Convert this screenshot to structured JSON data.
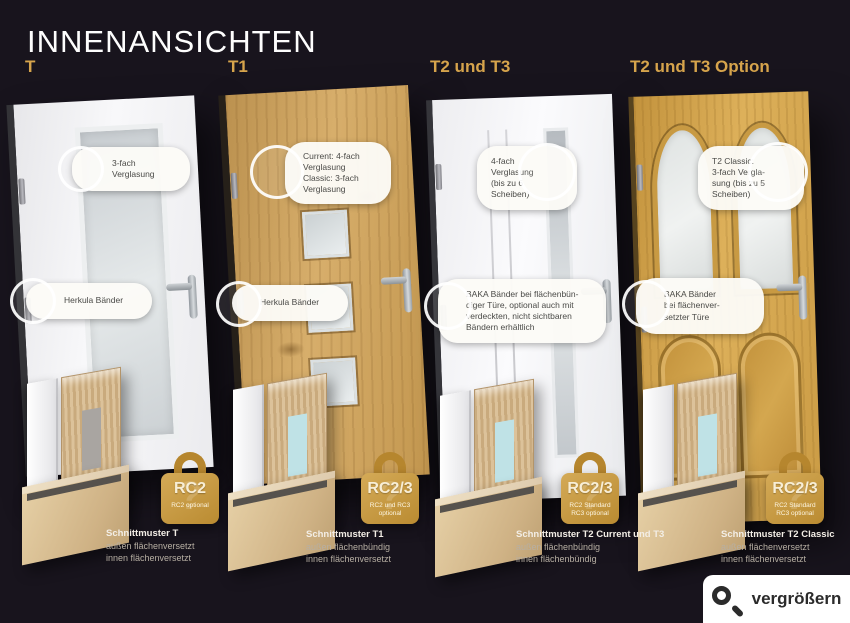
{
  "page": {
    "title": "INNENANSICHTEN"
  },
  "colors": {
    "background": "#18141d",
    "accent_gold": "#d6a44c",
    "lock_gold": "#c79a43",
    "callout_bg": "#fcfbf7"
  },
  "columns": [
    {
      "header": "T",
      "callouts": [
        {
          "text": "3-fach\nVerglasung"
        },
        {
          "text": "Herkula Bänder"
        }
      ],
      "lock": {
        "rating": "RC2",
        "note": "RC2 optional"
      },
      "caption": {
        "title": "Schnittmuster T",
        "line1": "außen flächenversetzt",
        "line2": "innen flächenversetzt"
      }
    },
    {
      "header": "T1",
      "callouts": [
        {
          "text": "Current: 4-fach\nVerglasung\nClassic: 3-fach\nVerglasung"
        },
        {
          "text": "Herkula Bänder"
        }
      ],
      "lock": {
        "rating": "RC2/3",
        "note": "RC2 und RC3 optional"
      },
      "caption": {
        "title": "Schnittmuster T1",
        "line1": "außen flächenbündig",
        "line2": "innen flächenversetzt"
      }
    },
    {
      "header": "T2 und T3",
      "callouts": [
        {
          "text": "4-fach\nVerglasung\n(bis zu 6\nScheiben)"
        },
        {
          "text": "BAKA Bänder bei flächenbün-\ndiger Türe, optional auch mit\nverdeckten, nicht sichtbaren\nBändern erhältlich"
        }
      ],
      "lock": {
        "rating": "RC2/3",
        "note": "RC2 Standard\nRC3 optional"
      },
      "caption": {
        "title": "Schnittmuster T2 Current und T3",
        "line1": "außen flächenbündig",
        "line2": "innen flächenbündig"
      }
    },
    {
      "header": "T2 und T3 Option",
      "callouts": [
        {
          "text": "T2 Classic:\n3-fach Vergla-\nsung (bis zu 5\nScheiben)"
        },
        {
          "text": "BAKA Bänder\nbei flächenver-\nsetzter Türe"
        }
      ],
      "lock": {
        "rating": "RC2/3",
        "note": "RC2 Standard\nRC3 optional"
      },
      "caption": {
        "title": "Schnittmuster T2 Classic",
        "line1": "außen flächenversetzt",
        "line2": "innen flächenversetzt"
      }
    }
  ],
  "zoom_button": {
    "label": "vergrößern"
  }
}
